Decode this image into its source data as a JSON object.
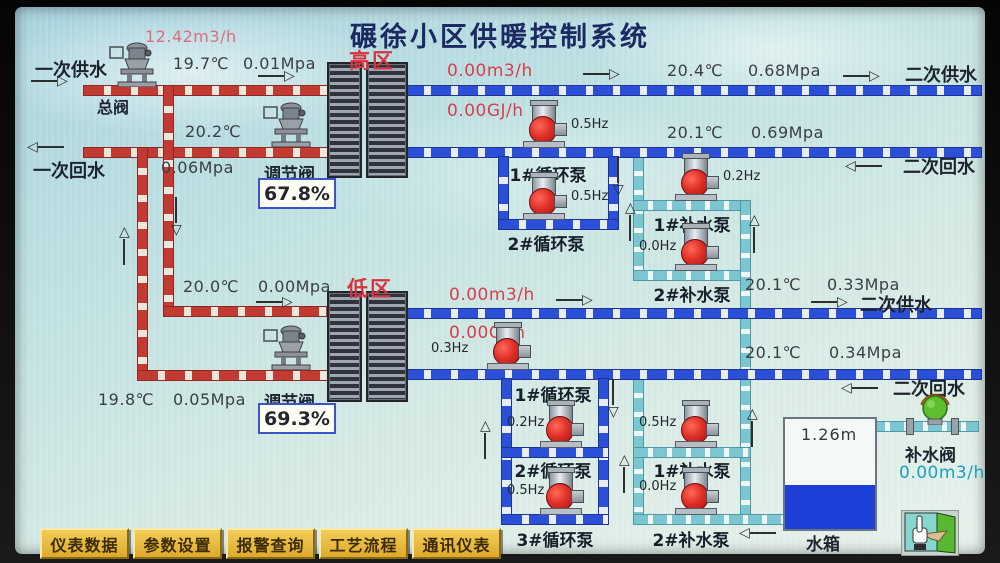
{
  "title": "碾徐小区供暖控制系统",
  "icons": {
    "arrow_right": "▷",
    "arrow_left": "◁",
    "arrow_up": "△",
    "arrow_down": "▽"
  },
  "colors": {
    "primary_pipe": "#c23a31",
    "secondary_pipe": "#2c4fd8",
    "makeup_pipe": "#7cc6d2",
    "alarm_text": "#d4404e",
    "title_text": "#1c2a63",
    "button_bg": "#e4b83d",
    "water_fill": "#1e3ed8",
    "makeup_valve_green": "#58b832"
  },
  "primary": {
    "supply_label": "一次供水",
    "return_label": "一次回水",
    "main_valve_label": "总阀",
    "flow": "12.42m3/h",
    "supply_temp": "19.7℃",
    "supply_pressure": "0.01Mpa",
    "return_temp": "20.2℃",
    "return_pressure": "0.06Mpa",
    "low_supply_temp": "20.0℃",
    "low_supply_pressure": "0.00Mpa",
    "low_return_temp": "19.8℃",
    "low_return_pressure": "0.05Mpa"
  },
  "high_zone": {
    "zone_label": "高区",
    "regulating_valve_label": "调节阀",
    "valve_opening": "67.8%",
    "flow": "0.00m3/h",
    "heat": "0.00GJ/h",
    "supply_temp": "20.4℃",
    "supply_pressure": "0.68Mpa",
    "return_temp": "20.1℃",
    "return_pressure": "0.69Mpa",
    "supply_label": "二次供水",
    "return_label": "二次回水",
    "circ_pumps": [
      {
        "label": "1#循环泵",
        "hz": "0.5Hz"
      },
      {
        "label": "2#循环泵",
        "hz": "0.5Hz"
      }
    ],
    "makeup_pumps": [
      {
        "label": "1#补水泵",
        "hz": "0.2Hz"
      },
      {
        "label": "2#补水泵",
        "hz": "0.0Hz"
      }
    ]
  },
  "low_zone": {
    "zone_label": "低区",
    "regulating_valve_label": "调节阀",
    "valve_opening": "69.3%",
    "flow": "0.00m3/h",
    "heat": "0.00GJ/h",
    "supply_temp": "20.1℃",
    "supply_pressure": "0.33Mpa",
    "return_temp": "20.1℃",
    "return_pressure": "0.34Mpa",
    "supply_label": "二次供水",
    "return_label": "二次回水",
    "circ_pumps": [
      {
        "label": "1#循环泵",
        "hz": "0.3Hz"
      },
      {
        "label": "2#循环泵",
        "hz": "0.2Hz"
      },
      {
        "label": "3#循环泵",
        "hz": "0.5Hz"
      }
    ],
    "makeup_pumps": [
      {
        "label": "1#补水泵",
        "hz": "0.5Hz"
      },
      {
        "label": "2#补水泵",
        "hz": "0.0Hz"
      }
    ]
  },
  "tank": {
    "label": "水箱",
    "level": "1.26m"
  },
  "makeup_valve": {
    "label": "补水阀",
    "flow": "0.00m3/h"
  },
  "nav_buttons": [
    {
      "label": "仪表数据"
    },
    {
      "label": "参数设置"
    },
    {
      "label": "报警查询"
    },
    {
      "label": "工艺流程"
    },
    {
      "label": "通讯仪表"
    }
  ]
}
